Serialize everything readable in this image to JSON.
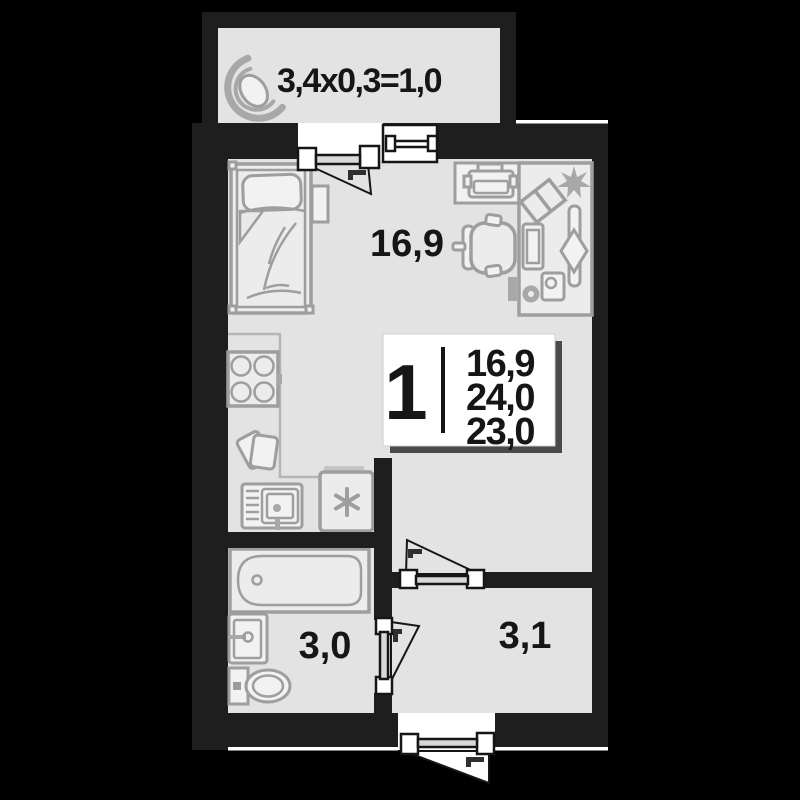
{
  "colors": {
    "background": "#000000",
    "wall": "#1e1e1e",
    "floor": "#e3e3e3",
    "furniture_line": "#9e9e9e",
    "label_text": "#161616",
    "card_shadow": "#4a4a4a"
  },
  "labels": {
    "balcony_dimensions": "3,4x0,3=1,0",
    "living_room_area": "16,9",
    "bathroom_area": "3,0",
    "hallway_area": "3,1"
  },
  "unit_card": {
    "room_count": "1",
    "living_area": "16,9",
    "total_area": "24,0",
    "area_without_balcony": "23,0"
  }
}
